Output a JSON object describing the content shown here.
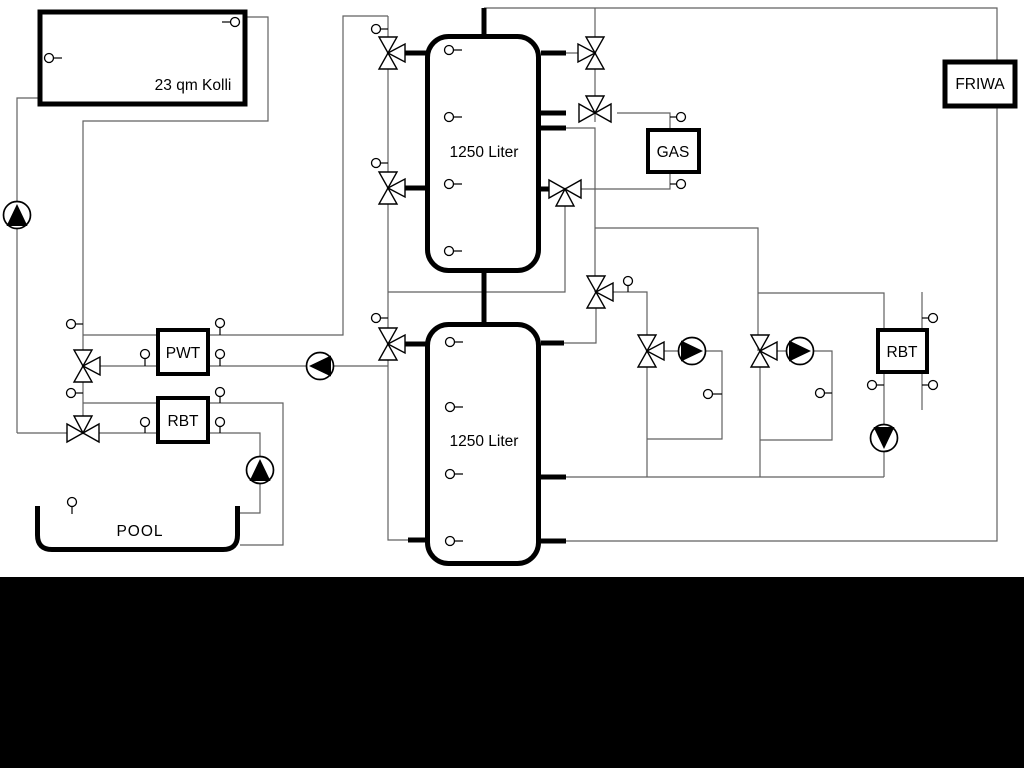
{
  "labels": {
    "collector": "23 qm Kolli",
    "tank_top": "1250 Liter",
    "tank_bottom": "1250 Liter",
    "pwt": "PWT",
    "rbt_left": "RBT",
    "rbt_right": "RBT",
    "gas": "GAS",
    "friwa": "FRIWA",
    "pool": "POOL"
  },
  "colors": {
    "pipe": "#616161",
    "component": "#000000",
    "background": "#ffffff",
    "footer_bar": "#000000"
  }
}
